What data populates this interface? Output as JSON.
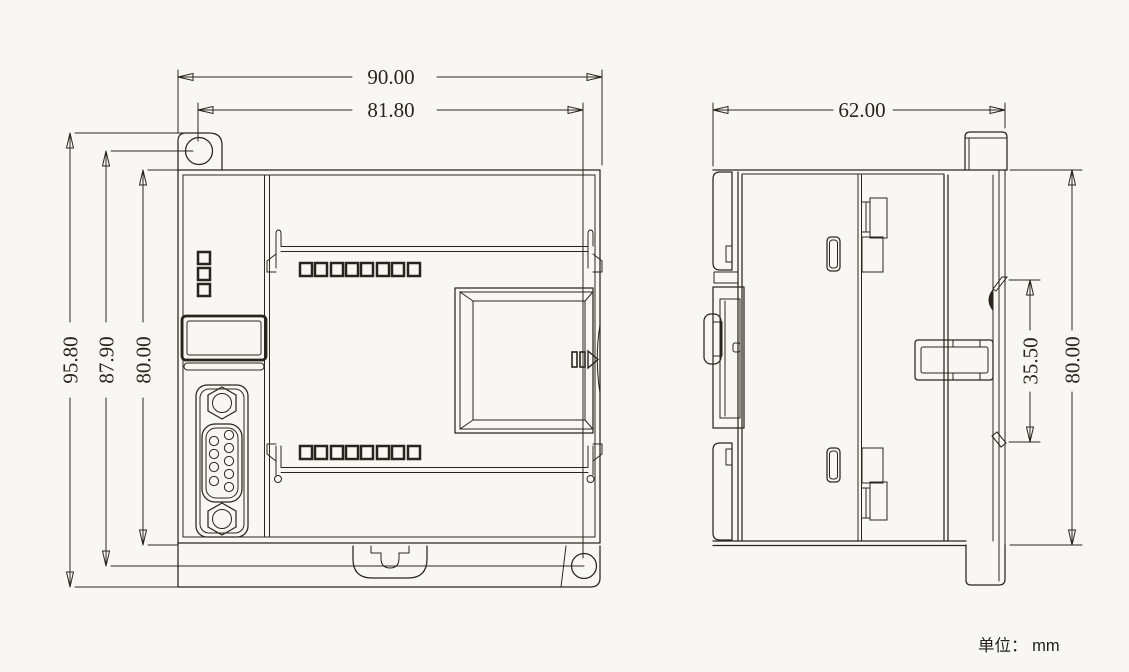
{
  "colors": {
    "background": "#f8f7f4",
    "line": "#2b241e",
    "text": "#2b241e"
  },
  "front_view": {
    "dim_overall_width": "90.00",
    "dim_hole_span_width": "81.80",
    "dim_overall_height": "95.80",
    "dim_hole_span_height": "87.90",
    "dim_body_height": "80.00"
  },
  "side_view": {
    "dim_depth": "62.00",
    "dim_rail_clip_span": "35.50",
    "dim_body_height": "80.00"
  },
  "footer": {
    "units_label": "单位： mm"
  }
}
